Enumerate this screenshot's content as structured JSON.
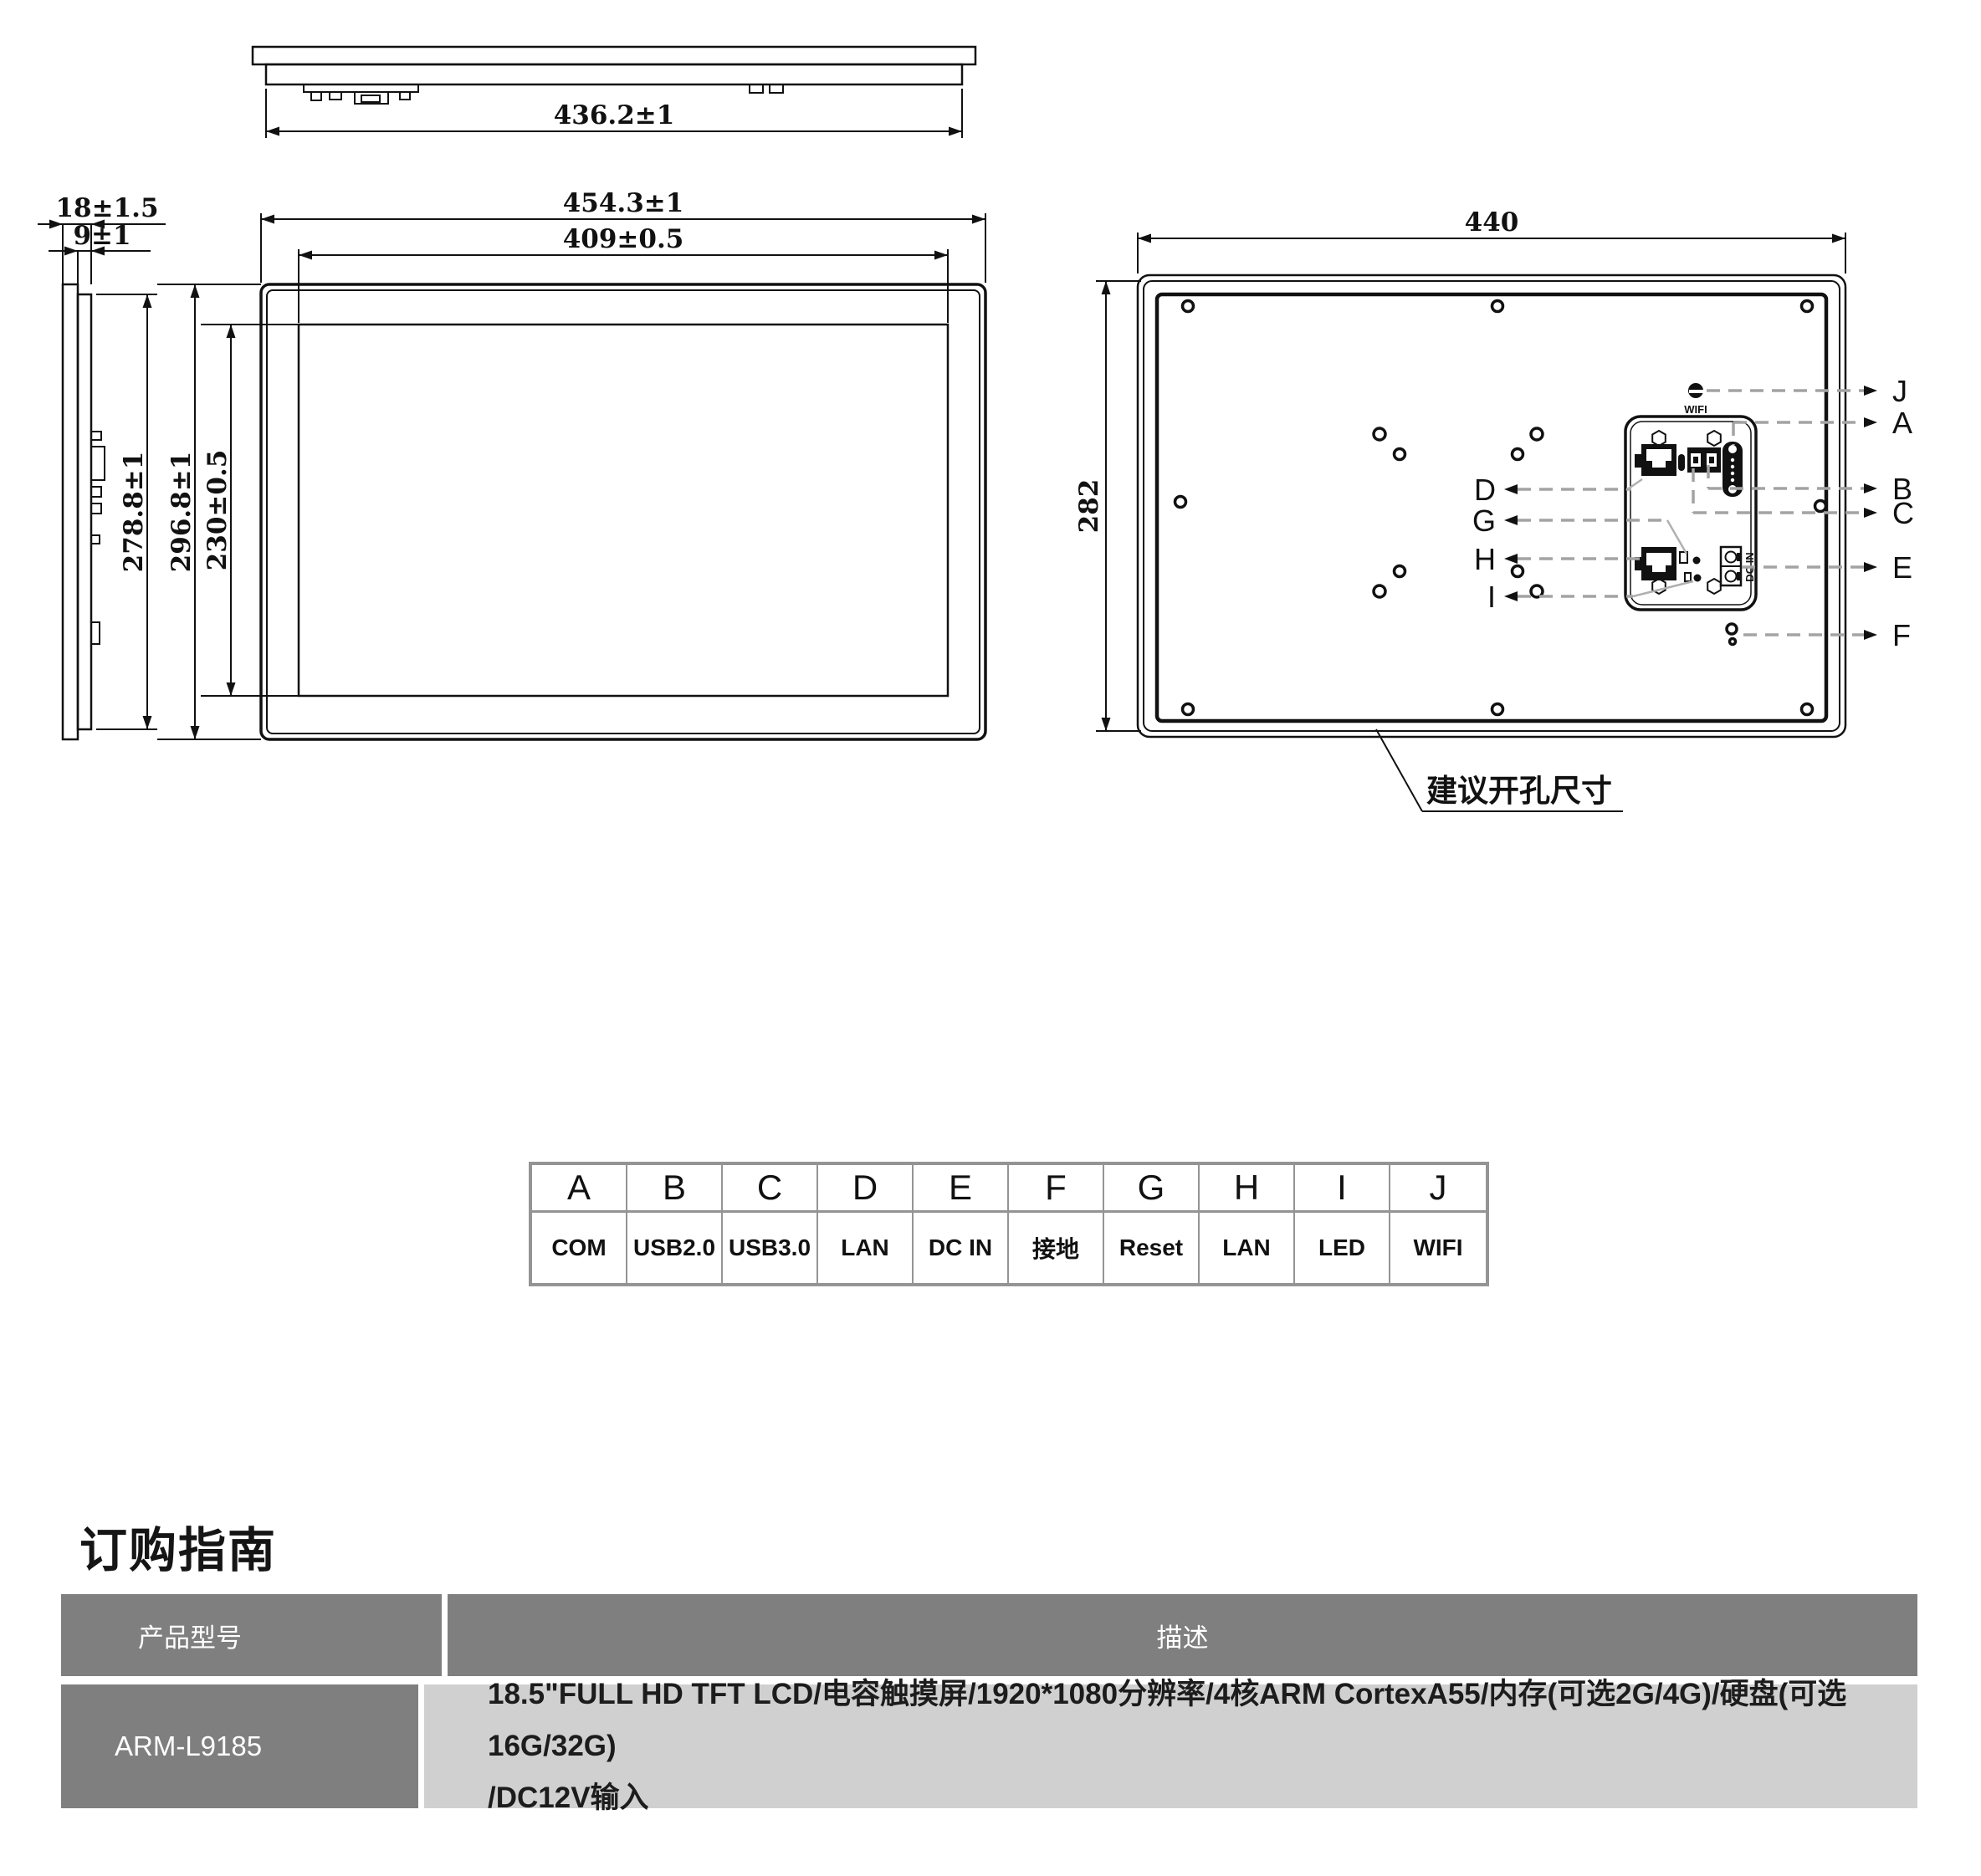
{
  "drawing": {
    "top_view": {
      "dim_width": "436.2±1"
    },
    "front_view": {
      "dim_outer_width": "454.3±1",
      "dim_display_width": "409±0.5",
      "dim_outer_height": "296.8±1",
      "dim_display_height": "230±0.5"
    },
    "side_view": {
      "dim_depth_total": "18±1.5",
      "dim_depth_body": "9±1",
      "dim_body_height": "278.8±1"
    },
    "rear_view": {
      "dim_width": "440",
      "dim_height": "282",
      "wifi_label": "WIFI",
      "dc_in_label": "DC IN",
      "cutout_note": "建议开孔尺寸",
      "leaders_right": [
        "J",
        "A",
        "B",
        "C",
        "E",
        "F"
      ],
      "leaders_left": [
        "D",
        "G",
        "H",
        "I"
      ]
    }
  },
  "port_table": {
    "headers": [
      "A",
      "B",
      "C",
      "D",
      "E",
      "F",
      "G",
      "H",
      "I",
      "J"
    ],
    "values": [
      "COM",
      "USB2.0",
      "USB3.0",
      "LAN",
      "DC IN",
      "接地",
      "Reset",
      "LAN",
      "LED",
      "WIFI"
    ]
  },
  "ordering": {
    "title": "订购指南",
    "col_model": "产品型号",
    "col_desc": "描述",
    "model": "ARM-L9185",
    "desc_line1": "18.5\"FULL HD TFT LCD/电容触摸屏/1920*1080分辨率/4核ARM CortexA55/内存(可选2G/4G)/硬盘(可选16G/32G)",
    "desc_line2": "/DC12V输入"
  }
}
